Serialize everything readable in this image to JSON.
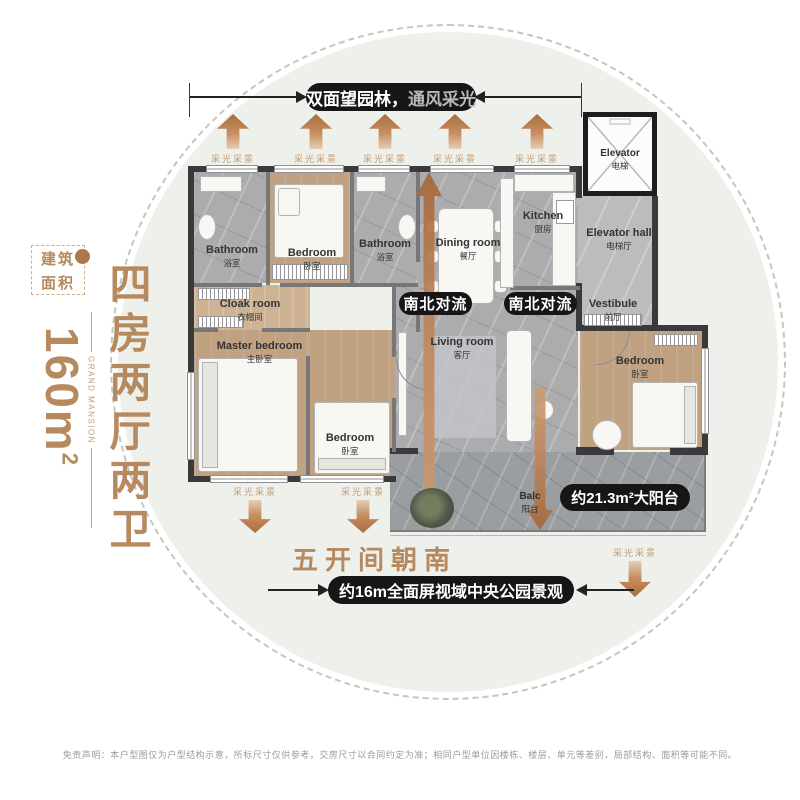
{
  "left_panel": {
    "badge_line1": "建筑",
    "badge_line2": "面积",
    "area_value": "160m",
    "area_sup": "2",
    "brand": "GRAND MANSION",
    "headline": "四房两厅两卫"
  },
  "banner": {
    "text_primary": "双面望园林，",
    "text_secondary": "通风采光"
  },
  "labels": {
    "light": "采光采景",
    "convection": "南北对流",
    "south": "五开间朝南",
    "balcony_area": "约21.3m²大阳台",
    "view": "约16m全面屏视域中央公园景观"
  },
  "rooms": {
    "bathroom1": {
      "en": "Bathroom",
      "zh": "浴室"
    },
    "bedroom_top": {
      "en": "Bedroom",
      "zh": "卧室"
    },
    "bathroom2": {
      "en": "Bathroom",
      "zh": "浴室"
    },
    "dining": {
      "en": "Dining room",
      "zh": "餐厅"
    },
    "kitchen": {
      "en": "Kitchen",
      "zh": "厨房"
    },
    "elevator": {
      "en": "Elevator",
      "zh": "电梯"
    },
    "elevator_hall": {
      "en": "Elevator hall",
      "zh": "电梯厅"
    },
    "cloak": {
      "en": "Cloak room",
      "zh": "衣帽间"
    },
    "master": {
      "en": "Master bedroom",
      "zh": "主卧室"
    },
    "living": {
      "en": "Living room",
      "zh": "客厅"
    },
    "vestibule": {
      "en": "Vestibule",
      "zh": "前厅"
    },
    "bedroom_mid": {
      "en": "Bedroom",
      "zh": "卧室"
    },
    "bedroom_right": {
      "en": "Bedroom",
      "zh": "卧室"
    },
    "balcony": {
      "en": "Balc",
      "zh": "阳台"
    }
  },
  "colors": {
    "accent_brown": "#b7895f",
    "arrow_orange": "#b06f3e",
    "pill_black": "#161616",
    "circle_fill": "#eef0ec"
  },
  "disclaimer": "免责声明：本户型图仅为户型结构示意，所标尺寸仅供参考，交房尺寸以合同约定为准；相同户型单位因楼栋、楼层、单元等差别，局部结构、面积等可能不同。"
}
